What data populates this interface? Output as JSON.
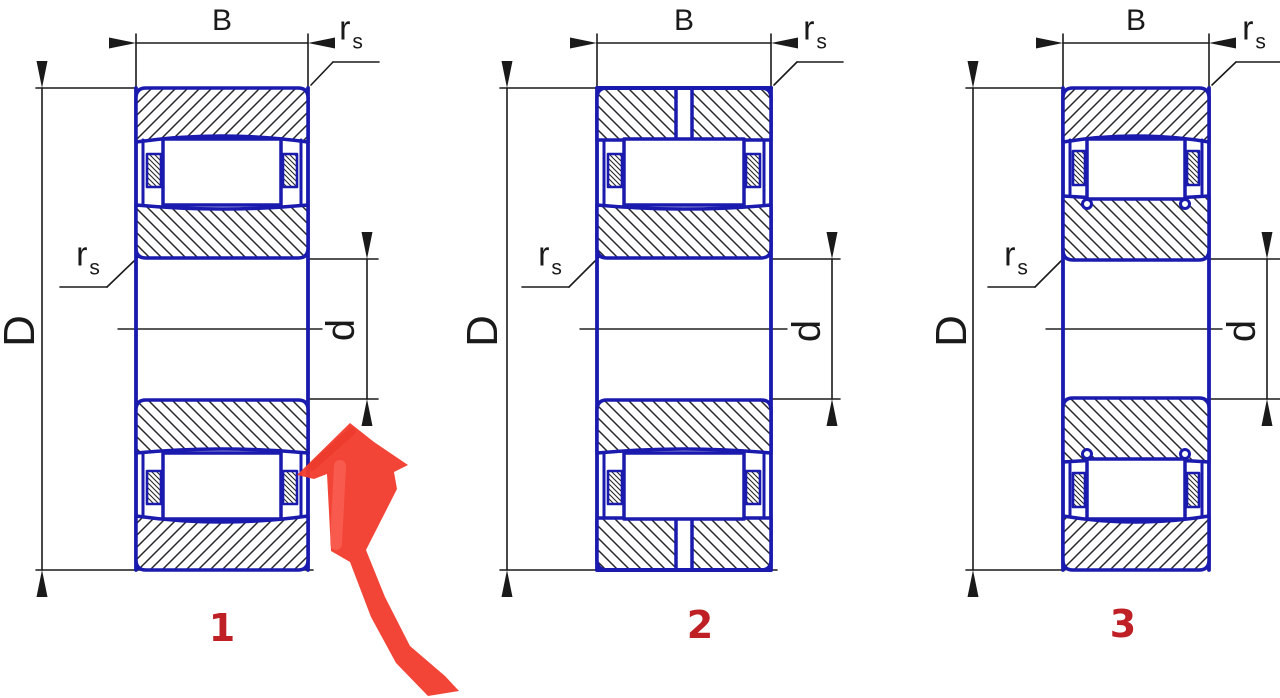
{
  "title": "Cylindrical roller bearing cross-section types",
  "labels": {
    "width": "B",
    "outer_diameter": "D",
    "bore_diameter": "d",
    "fillet_radius": "r",
    "fillet_radius_sub": "s"
  },
  "figures": [
    {
      "number": "1"
    },
    {
      "number": "2"
    },
    {
      "number": "3"
    }
  ],
  "colors": {
    "drawing_blue": "#1a1aae",
    "dimension_black": "#1a1a1a",
    "hatch_dark": "#26262b",
    "figure_number_red": "#bf2026",
    "marker_arrow_red": "#f23b2c",
    "background": "#ffffff"
  }
}
